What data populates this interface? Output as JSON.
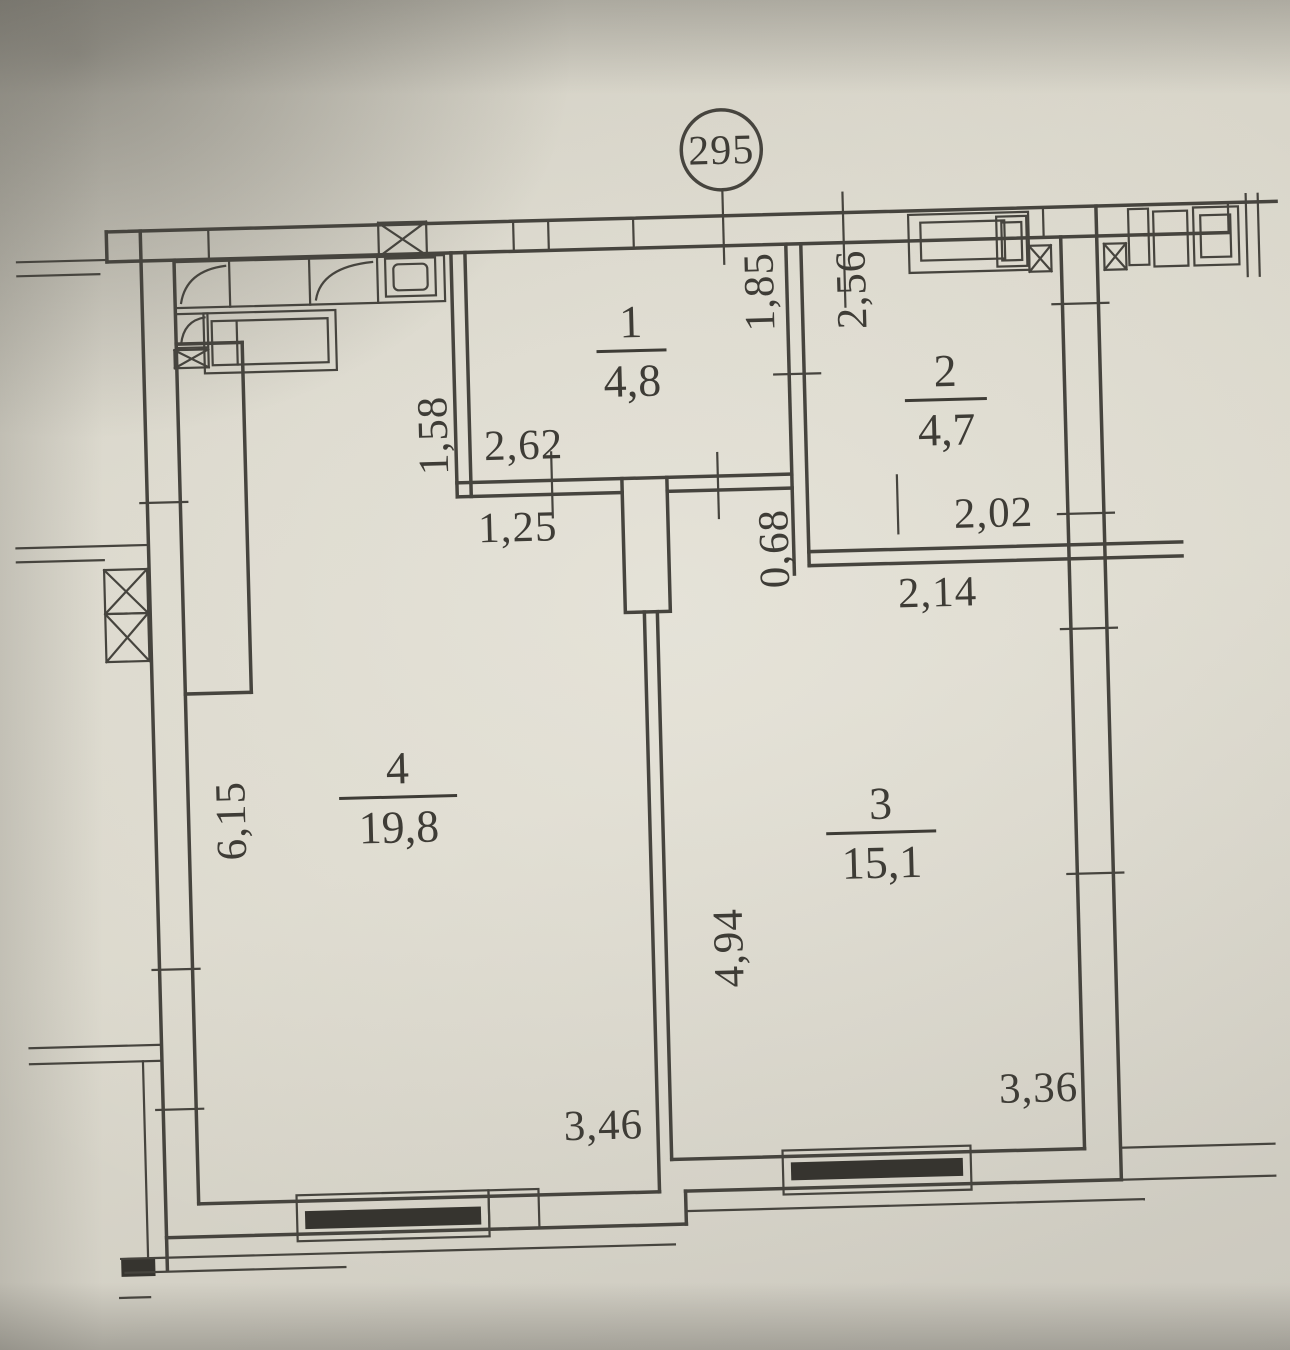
{
  "apartment_badge": "295",
  "rooms": [
    {
      "number": "1",
      "area": "4,8"
    },
    {
      "number": "2",
      "area": "4,7"
    },
    {
      "number": "3",
      "area": "15,1"
    },
    {
      "number": "4",
      "area": "19,8"
    }
  ],
  "dimensions": {
    "d262": "2,62",
    "d125": "1,25",
    "d158": "1,58",
    "d185": "1,85",
    "d256": "2,56",
    "d068": "0,68",
    "d202": "2,02",
    "d214": "2,14",
    "d615": "6,15",
    "d494": "4,94",
    "d346": "3,46",
    "d336": "3,36"
  },
  "colors": {
    "ink": "#3e3c36",
    "line": "#46443e",
    "paper": "#d6d3c7"
  }
}
